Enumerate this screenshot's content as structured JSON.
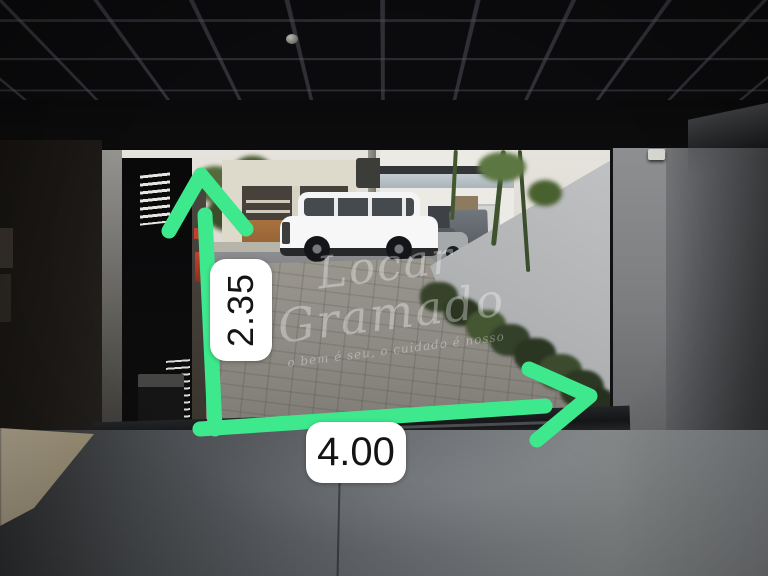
{
  "annotations": {
    "height_value": "2.35",
    "width_value": "4.00",
    "arrow_color": "#3de98c",
    "label_background": "#ffffff",
    "label_text_color": "#141414"
  },
  "watermark": {
    "line1": "Locar",
    "line2": "Gramado",
    "tagline": "o bem é seu, o cuidado é nosso"
  }
}
